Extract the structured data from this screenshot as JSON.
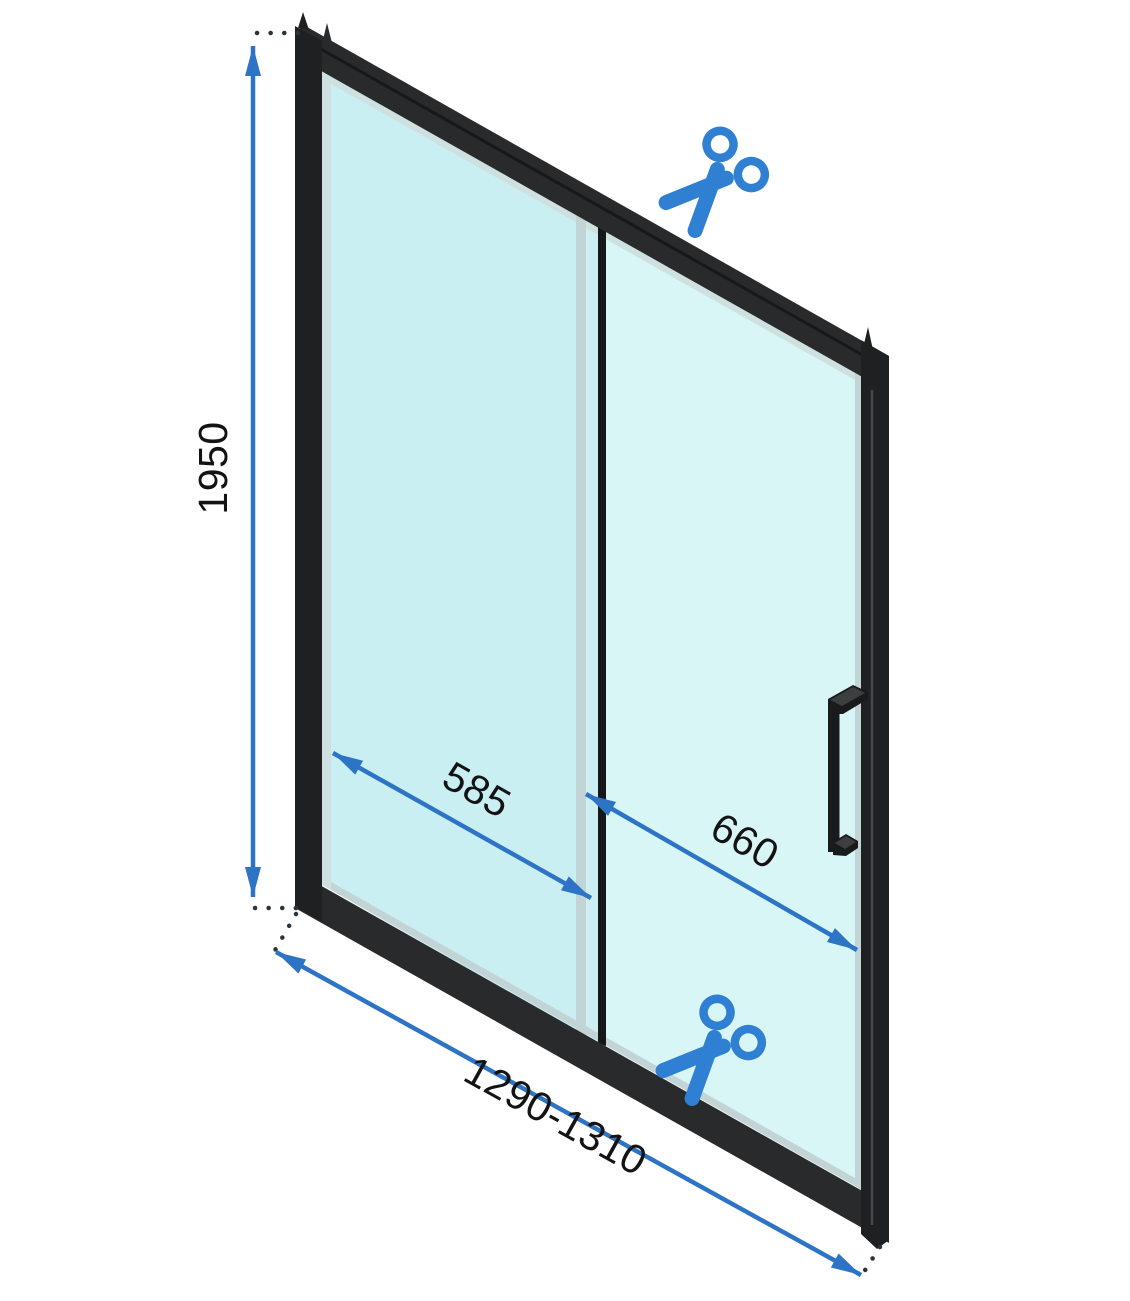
{
  "dimensions": {
    "height": "1950",
    "panel_width": "585",
    "door_opening_width": "660",
    "total_width_range": "1290-1310"
  },
  "icons": {
    "cut_mark_top": "scissors-icon",
    "cut_mark_bottom": "scissors-icon"
  },
  "colors": {
    "dim_blue": "#2e74c6",
    "scissors_blue": "#2f80d3",
    "frame_black": "#282a2b",
    "frame_side": "#1e2021",
    "frame_seam": "#17181a",
    "frame_highlight": "#45484a",
    "glass_left": "#c9eff3",
    "glass_mid": "#cdeff2",
    "glass_right": "#d9f6f6",
    "glass_edge": "#cfe0e0",
    "glass_edge_dark": "#c3d4d6",
    "divider_black": "#161718",
    "handle_black": "#191a1b",
    "handle_highlight": "#3c3e3f",
    "dot_color": "#2b333d",
    "label_color": "#131313",
    "background": "#ffffff"
  }
}
